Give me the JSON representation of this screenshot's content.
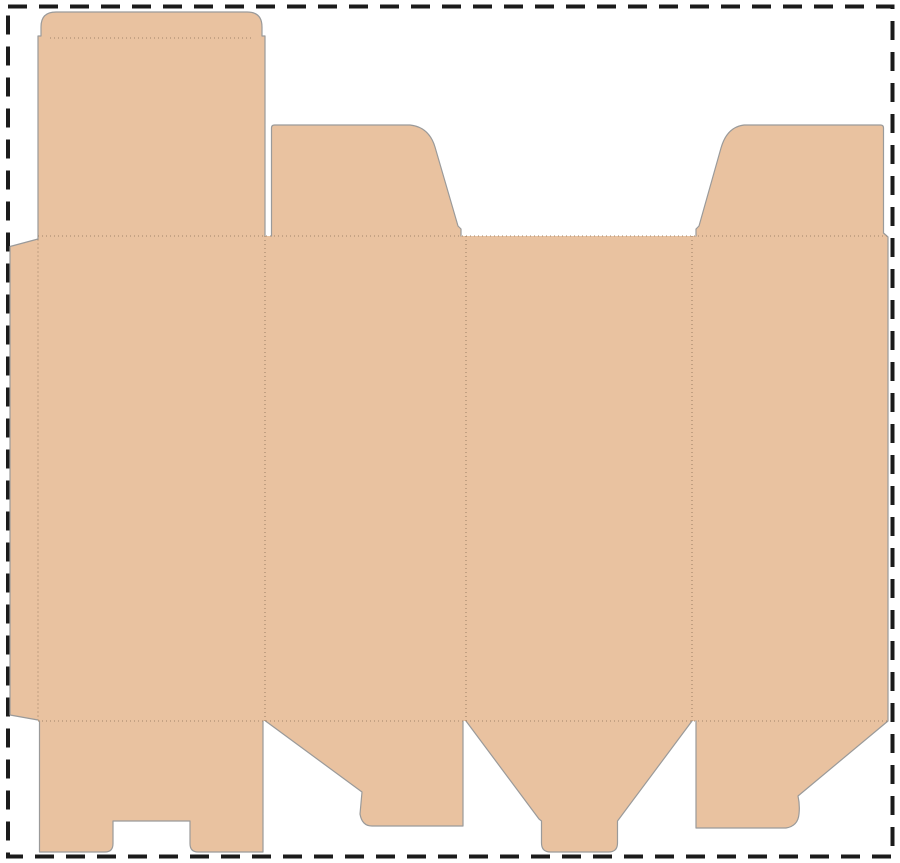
{
  "diagram": {
    "type": "packaging-dieline",
    "title": "Folding carton box dieline (flat die-cut template)",
    "canvas": {
      "width": 900,
      "height": 863
    },
    "colors": {
      "background": "#ffffff",
      "material": "#e9c2a0",
      "cut_line": "#9a9a9a",
      "fold_line": "#a1846a",
      "artboard_border": "#1b1b1b"
    },
    "artboard_border": {
      "x": 8,
      "y": 6.5,
      "width": 884.5,
      "height": 850,
      "stroke_width": 4,
      "dash_pattern": "19 12"
    },
    "silhouette": {
      "fill_path": "M 38,36 L 41,36 L 41,27 Q 41,12 56,12 L 247,12 Q 262,12 262,27 L 262,36 L 265,36 L 265,236 L 271.5,236 L 271.5,128 Q 271.5,125 274.5,125 L 410,125 Q 429,127 435,147 L 458,226 L 461,229 L 461,236 L 696,236 L 696,229 L 699,226 L 721,148 Q 727,127 744,125 L 880.5,125 Q 883.5,125 883.5,128 L 883.5,233 L 888,237 L 888,721 L 798,796 Q 800,805 799,814 Q 798,826 786,828 L 696,828 L 696,721 L 692,721 L 619,819 L 617.5,821 L 617.5,843 Q 617.5,852 608.5,852 L 550.5,852 Q 541.5,852 541.5,843 L 541.5,821 L 539,819 L 466,721 L 463,721 L 463,826 L 372,826 Q 362,826 360,814 L 362,792 L 265.5,721 L 263,721 L 263,852 L 198,852 Q 190,852 190,843.5 L 190,821 L 113,821 L 113,843.5 Q 113,852 105,852 L 39.5,852 L 39.5,721 L 38,720 L 10,715 L 10,246.5 L 38,239 Z"
    },
    "cuts": {
      "path": "M 38,36 L 41,36 L 41,27 Q 41,12 56,12 L 247,12 Q 262,12 262,27 L 262,36 L 265,36 L 265,236 M 271.5,236 L 271.5,128 Q 271.5,125 274.5,125 L 410,125 Q 429,127 435,147 L 458,226 L 461,229 L 461,236 M 696,236 L 696,229 L 699,226 L 721,148 Q 727,127 744,125 L 880.5,125 Q 883.5,125 883.5,128 L 883.5,233 L 888,237 L 888,721 L 798,796 Q 800,805 799,814 Q 798,826 786,828 L 696,828 L 696,721 M 692,721 L 619,819 L 617.5,821 L 617.5,843 Q 617.5,852 608.5,852 L 550.5,852 Q 541.5,852 541.5,843 L 541.5,821 L 539,819 L 466,721 M 463,721 L 463,826 L 372,826 Q 362,826 360,814 L 362,792 L 265.5,721 M 263,721 L 263,852 L 198,852 Q 190,852 190,843.5 L 190,821 L 113,821 L 113,843.5 Q 113,852 105,852 L 39.5,852 L 39.5,721 M 38,720 L 10,715 L 10,246.5 L 38,239 L 38,36"
    },
    "folds": [
      {
        "name": "tuck-flap-fold",
        "d": "M 50,38 L 253,38"
      },
      {
        "name": "top-panels-fold",
        "d": "M 38,236 L 888,236"
      },
      {
        "name": "bottom-panels-fold",
        "d": "M 38,721 L 888,721"
      },
      {
        "name": "glue-flap-fold",
        "d": "M 38,239.5 L 38,720"
      },
      {
        "name": "panel-1-2-fold",
        "d": "M 265,236 L 265,721"
      },
      {
        "name": "panel-2-3-fold",
        "d": "M 466,236 L 466,721"
      },
      {
        "name": "panel-3-4-fold",
        "d": "M 692,236 L 692,721"
      }
    ],
    "parts": [
      "glue-flap",
      "panel-1",
      "panel-2",
      "panel-3",
      "panel-4",
      "tuck-flap",
      "top-lid-flap",
      "top-dust-flap-left",
      "top-dust-flap-right",
      "bottom-flap-notched",
      "bottom-flap-angled-left",
      "bottom-flap-tabbed",
      "bottom-flap-angled-right"
    ]
  }
}
